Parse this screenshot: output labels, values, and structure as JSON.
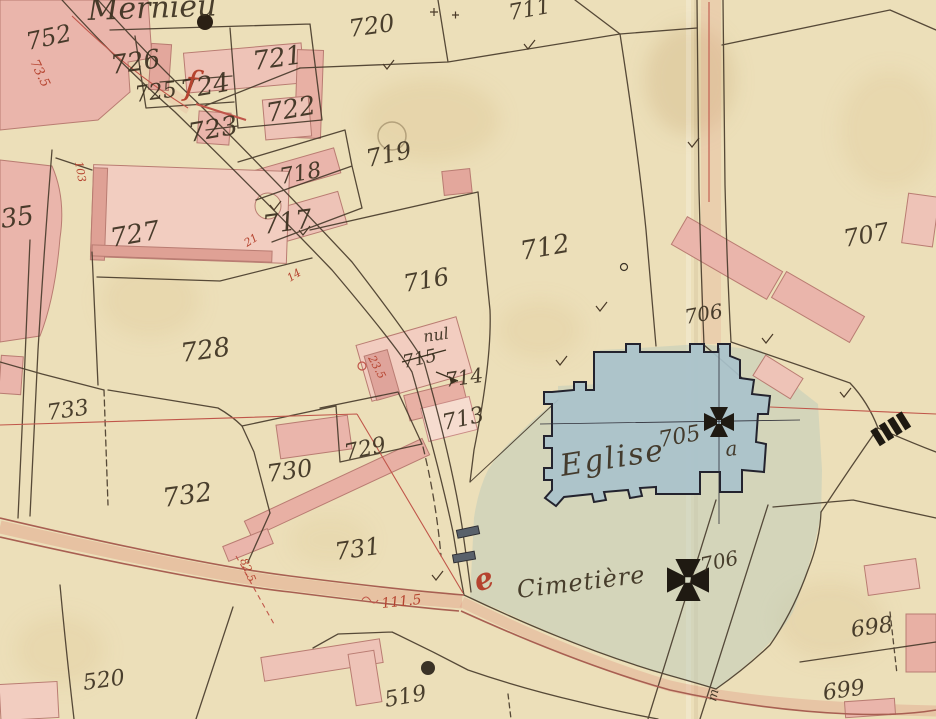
{
  "map": {
    "title": "Mernieu",
    "church": {
      "label": "Eglise",
      "parcel": "705",
      "letter": "a"
    },
    "cemetery": {
      "label": "Cimetière",
      "parcel": "706",
      "letter_red": "e",
      "letter_gate": "m"
    },
    "void_building": {
      "note": "nul",
      "number": "715"
    },
    "parcels": [
      {
        "number": "752"
      },
      {
        "number": "726"
      },
      {
        "number": "725"
      },
      {
        "number": "724"
      },
      {
        "number": "721"
      },
      {
        "number": "722"
      },
      {
        "number": "723"
      },
      {
        "number": "720"
      },
      {
        "number": "711"
      },
      {
        "number": "719"
      },
      {
        "number": "718"
      },
      {
        "number": "717"
      },
      {
        "number": "727"
      },
      {
        "number": "728"
      },
      {
        "number": "716"
      },
      {
        "number": "712"
      },
      {
        "number": "707"
      },
      {
        "number": "706"
      },
      {
        "number": "714"
      },
      {
        "number": "713"
      },
      {
        "number": "733"
      },
      {
        "number": "732"
      },
      {
        "number": "730"
      },
      {
        "number": "729"
      },
      {
        "number": "731"
      },
      {
        "number": "698"
      },
      {
        "number": "699"
      },
      {
        "number": "520"
      },
      {
        "number": "519"
      },
      {
        "number": "735",
        "partial": "35"
      }
    ],
    "red_survey_marks": {
      "m1": "73.5",
      "m2": "103",
      "m3": "21",
      "m4": "14",
      "m5": "23.5",
      "m6": "82.5",
      "m7": "111.5",
      "flag": "f"
    },
    "symbols": {
      "church_cross": "maltese-cross",
      "cemetery_cross": "maltese-cross",
      "gate": "gate-bars",
      "stile": "hatched-stile",
      "well": "well-dot"
    },
    "colors": {
      "paper": "#ecdfb9",
      "building_pink": "#eab5ab",
      "church_blue": "#a9c2cc",
      "cemetery_wash": "#bccbbc",
      "ink": "#46392a",
      "red_ink": "#b5432f",
      "road_red": "#a85f52"
    }
  }
}
